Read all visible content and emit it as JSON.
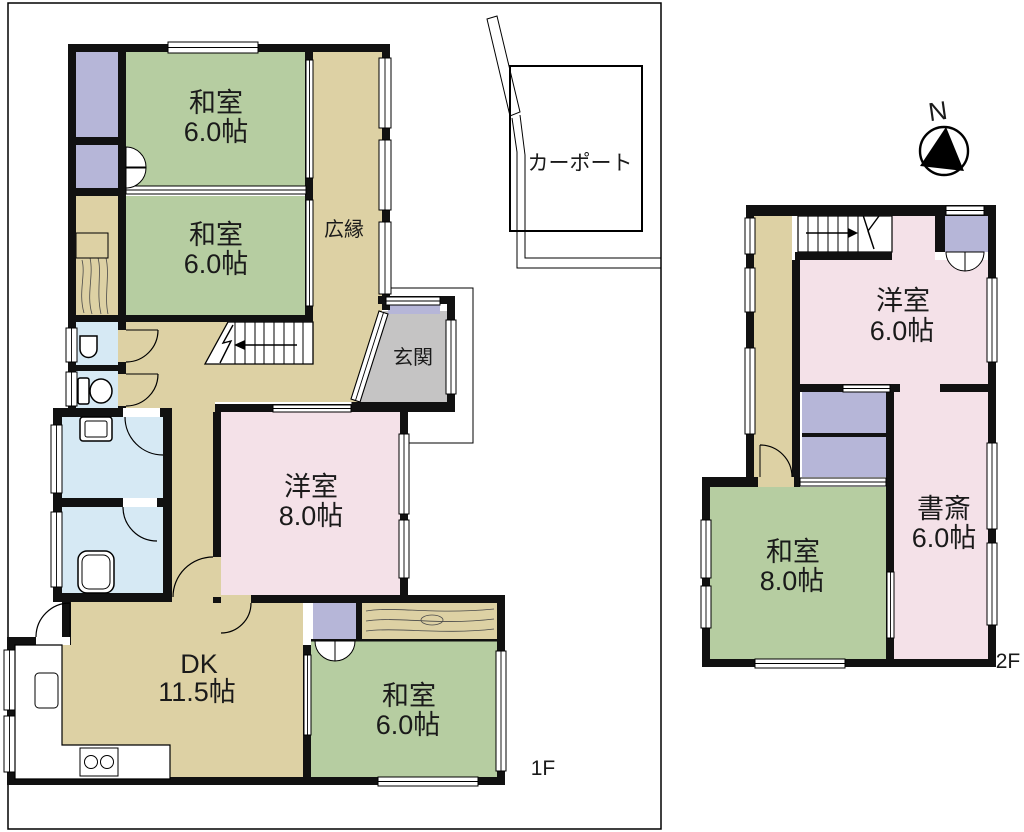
{
  "compass": {
    "label": "N"
  },
  "carport": {
    "label": "カーポート"
  },
  "floor1": {
    "label": "1F",
    "rooms": {
      "washitsu_a": {
        "name": "和室",
        "size": "6.0帖"
      },
      "washitsu_b": {
        "name": "和室",
        "size": "6.0帖"
      },
      "hiroen": {
        "name": "広縁"
      },
      "genkan": {
        "name": "玄関"
      },
      "yoshitsu": {
        "name": "洋室",
        "size": "8.0帖"
      },
      "dk": {
        "name": "DK",
        "size": "11.5帖"
      },
      "washitsu_c": {
        "name": "和室",
        "size": "6.0帖"
      }
    }
  },
  "floor2": {
    "label": "2F",
    "rooms": {
      "yoshitsu": {
        "name": "洋室",
        "size": "6.0帖"
      },
      "washitsu": {
        "name": "和室",
        "size": "8.0帖"
      },
      "shosai": {
        "name": "書斎",
        "size": "6.0帖"
      }
    }
  },
  "colors": {
    "wall": "#111111",
    "tatami_green": "#b6cda1",
    "wood_tan": "#ddd1a4",
    "pink": "#f4e1e8",
    "closet_purple": "#b6b6d8",
    "wet_blue": "#d6e9f4",
    "genkan_gray": "#c5c4c4"
  }
}
